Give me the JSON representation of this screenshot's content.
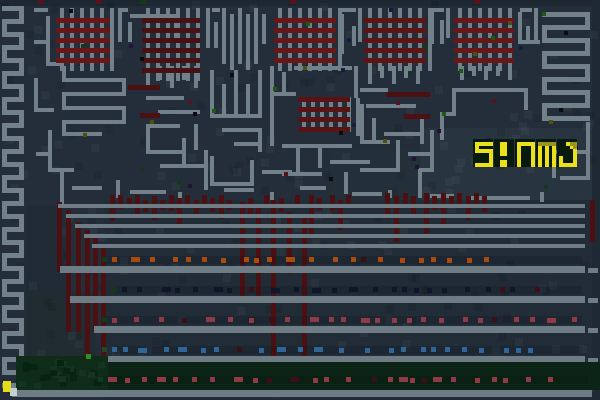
{
  "window": {
    "width": 600,
    "height": 400,
    "kind": "pixel-art game frame"
  },
  "hud": {
    "score_text": "SIUMO",
    "x": 474,
    "y": 140,
    "cell": 3.5,
    "tile_w": 20,
    "tile_h": 28,
    "pitch": 21,
    "tile_bg": "#081a0d",
    "fg": "#ecdf1c",
    "shade": "#99931f",
    "glyphs": {
      "S": [
        "11111",
        "10000",
        "11111",
        "00001",
        "00001",
        "00001",
        "11111"
      ],
      "I": [
        "01100",
        "01100",
        "01100",
        "01100",
        "00000",
        "01100",
        "01100"
      ],
      "U": [
        "11111",
        "10001",
        "10001",
        "10001",
        "10001",
        "10001",
        "10001"
      ],
      "M": [
        "22222",
        "10101",
        "10101",
        "10101",
        "10101",
        "10101",
        "10101"
      ],
      "O": [
        "00122",
        "00012",
        "00001",
        "00001",
        "10001",
        "10001",
        "11111"
      ]
    }
  },
  "palette": {
    "bg": "#232e3a",
    "maze": "#72808a",
    "brick_red": "#661616",
    "brick_red_dark": "#471113",
    "drip": "#4a1012",
    "stripe": "#6e7c85",
    "orange": "#a84b10",
    "crimson": "#8e3b46",
    "blue": "#30659a",
    "navy_dash": "#10152a",
    "green_band": "#0c2415",
    "green_blob": "#0f2c19",
    "yellow_block": "#e3de16",
    "white_block": "#c8d1ce"
  },
  "scene": {
    "patches": [
      [
        0,
        0,
        600,
        6,
        "#1c2731"
      ],
      [
        592,
        0,
        8,
        400,
        "#1e2933"
      ],
      [
        26,
        205,
        44,
        150,
        "#202b36"
      ],
      [
        26,
        292,
        70,
        66,
        "#202c31"
      ],
      [
        420,
        128,
        172,
        72,
        "#283440"
      ],
      [
        330,
        150,
        90,
        46,
        "#243039"
      ],
      [
        104,
        200,
        488,
        200,
        "#212c37"
      ]
    ],
    "left_serpentine": {
      "x0": 2,
      "x1": 24,
      "y0": 6,
      "step": 13,
      "count": 30,
      "t": 5
    },
    "right_radiator": {
      "x0": 542,
      "x1": 590,
      "y0": 12,
      "step": 13,
      "count": 9,
      "t": 5
    },
    "top_vcomb": {
      "x0": 222,
      "y0": 8,
      "h": 56,
      "step": 8,
      "count": 5,
      "t": 4
    },
    "bricks": [
      {
        "x": 56,
        "y": 18,
        "w": 54,
        "bars": 5,
        "bar_h": 5,
        "bar_step": 10,
        "cols": 6,
        "col_w": 4,
        "col_step": 10,
        "red": "#6b1616",
        "ticks": true
      },
      {
        "x": 142,
        "y": 18,
        "w": 58,
        "bars": 6,
        "bar_h": 5,
        "bar_step": 10,
        "cols": 6,
        "col_w": 4,
        "col_step": 10,
        "red": "#471113",
        "ticks": true
      },
      {
        "x": 274,
        "y": 18,
        "w": 62,
        "bars": 5,
        "bar_h": 5,
        "bar_step": 10,
        "cols": 7,
        "col_w": 4,
        "col_step": 10,
        "red": "#6b1616",
        "ticks": true
      },
      {
        "x": 364,
        "y": 18,
        "w": 62,
        "bars": 5,
        "bar_h": 5,
        "bar_step": 10,
        "cols": 7,
        "col_w": 4,
        "col_step": 10,
        "red": "#5f1414",
        "ticks": true
      },
      {
        "x": 454,
        "y": 18,
        "w": 60,
        "bars": 5,
        "bar_h": 5,
        "bar_step": 10,
        "cols": 6,
        "col_w": 4,
        "col_step": 10,
        "red": "#6b1616",
        "ticks": true
      },
      {
        "x": 298,
        "y": 97,
        "w": 52,
        "bars": 4,
        "bar_h": 5,
        "bar_step": 10,
        "cols": 6,
        "col_w": 4,
        "col_step": 9,
        "red": "#5a1313",
        "ticks": false
      }
    ],
    "red_bars": [
      [
        128,
        85,
        32
      ],
      [
        140,
        113,
        20
      ],
      [
        386,
        92,
        44
      ],
      [
        404,
        114,
        26
      ]
    ],
    "maze_segments": [
      [
        34,
        8,
        14,
        4
      ],
      [
        118,
        8,
        10,
        4
      ],
      [
        130,
        14,
        44,
        4
      ],
      [
        212,
        8,
        8,
        4
      ],
      [
        342,
        8,
        14,
        4
      ],
      [
        432,
        8,
        12,
        4
      ],
      [
        520,
        8,
        12,
        4
      ],
      [
        118,
        8,
        4,
        34
      ],
      [
        128,
        22,
        4,
        20
      ],
      [
        174,
        14,
        4,
        28
      ],
      [
        206,
        8,
        4,
        40
      ],
      [
        214,
        22,
        4,
        26
      ],
      [
        262,
        14,
        4,
        30
      ],
      [
        340,
        14,
        4,
        40
      ],
      [
        352,
        26,
        4,
        20
      ],
      [
        358,
        8,
        4,
        34
      ],
      [
        430,
        8,
        4,
        36
      ],
      [
        440,
        20,
        4,
        24
      ],
      [
        446,
        8,
        4,
        30
      ],
      [
        518,
        12,
        4,
        30
      ],
      [
        526,
        26,
        4,
        18
      ],
      [
        534,
        8,
        4,
        36
      ],
      [
        518,
        40,
        22,
        4
      ],
      [
        46,
        16,
        4,
        50
      ],
      [
        34,
        40,
        12,
        4
      ],
      [
        46,
        62,
        16,
        4
      ],
      [
        34,
        78,
        4,
        30
      ],
      [
        34,
        108,
        20,
        4
      ],
      [
        48,
        130,
        4,
        42
      ],
      [
        36,
        152,
        12,
        4
      ],
      [
        48,
        168,
        26,
        4
      ],
      [
        62,
        66,
        4,
        12
      ],
      [
        62,
        78,
        64,
        4
      ],
      [
        122,
        82,
        4,
        10
      ],
      [
        62,
        92,
        64,
        4
      ],
      [
        62,
        96,
        4,
        10
      ],
      [
        62,
        106,
        64,
        4
      ],
      [
        122,
        110,
        4,
        10
      ],
      [
        62,
        120,
        64,
        4
      ],
      [
        62,
        124,
        4,
        8
      ],
      [
        62,
        132,
        40,
        4
      ],
      [
        146,
        66,
        4,
        22
      ],
      [
        158,
        66,
        4,
        14
      ],
      [
        170,
        66,
        4,
        22
      ],
      [
        182,
        66,
        4,
        14
      ],
      [
        194,
        66,
        4,
        22
      ],
      [
        146,
        96,
        38,
        4
      ],
      [
        158,
        110,
        42,
        4
      ],
      [
        146,
        124,
        34,
        4
      ],
      [
        146,
        124,
        4,
        28
      ],
      [
        146,
        150,
        40,
        4
      ],
      [
        182,
        138,
        4,
        30
      ],
      [
        194,
        124,
        4,
        26
      ],
      [
        160,
        164,
        46,
        4
      ],
      [
        204,
        150,
        4,
        40
      ],
      [
        210,
        70,
        4,
        44
      ],
      [
        222,
        84,
        4,
        32
      ],
      [
        234,
        70,
        4,
        44
      ],
      [
        246,
        84,
        4,
        32
      ],
      [
        258,
        70,
        4,
        44
      ],
      [
        210,
        114,
        52,
        4
      ],
      [
        222,
        128,
        40,
        4
      ],
      [
        258,
        128,
        4,
        24
      ],
      [
        234,
        142,
        28,
        4
      ],
      [
        210,
        156,
        4,
        28
      ],
      [
        210,
        182,
        44,
        4
      ],
      [
        250,
        160,
        4,
        24
      ],
      [
        262,
        170,
        30,
        4
      ],
      [
        270,
        66,
        4,
        28
      ],
      [
        282,
        72,
        4,
        22
      ],
      [
        294,
        66,
        58,
        4
      ],
      [
        354,
        66,
        4,
        32
      ],
      [
        270,
        92,
        26,
        4
      ],
      [
        270,
        96,
        4,
        50
      ],
      [
        356,
        98,
        4,
        38
      ],
      [
        282,
        144,
        70,
        4
      ],
      [
        296,
        148,
        4,
        26
      ],
      [
        282,
        172,
        40,
        4
      ],
      [
        318,
        148,
        4,
        20
      ],
      [
        330,
        160,
        40,
        4
      ],
      [
        344,
        172,
        4,
        22
      ],
      [
        368,
        66,
        4,
        18
      ],
      [
        380,
        66,
        4,
        12
      ],
      [
        392,
        66,
        4,
        18
      ],
      [
        404,
        66,
        4,
        12
      ],
      [
        416,
        66,
        4,
        18
      ],
      [
        360,
        88,
        28,
        4
      ],
      [
        366,
        104,
        50,
        4
      ],
      [
        360,
        104,
        4,
        36
      ],
      [
        372,
        118,
        4,
        26
      ],
      [
        384,
        132,
        36,
        4
      ],
      [
        360,
        140,
        30,
        4
      ],
      [
        396,
        140,
        4,
        30
      ],
      [
        360,
        168,
        40,
        4
      ],
      [
        408,
        152,
        26,
        4
      ],
      [
        420,
        118,
        4,
        26
      ],
      [
        430,
        130,
        4,
        42
      ],
      [
        418,
        168,
        16,
        4
      ],
      [
        418,
        170,
        4,
        28
      ],
      [
        430,
        194,
        24,
        4
      ],
      [
        460,
        66,
        4,
        14
      ],
      [
        472,
        66,
        4,
        10
      ],
      [
        484,
        66,
        4,
        14
      ],
      [
        496,
        66,
        4,
        10
      ],
      [
        508,
        66,
        4,
        14
      ],
      [
        456,
        88,
        70,
        4
      ],
      [
        452,
        88,
        4,
        26
      ],
      [
        440,
        112,
        16,
        4
      ],
      [
        440,
        112,
        4,
        28
      ],
      [
        524,
        88,
        4,
        22
      ],
      [
        556,
        150,
        34,
        4
      ],
      [
        552,
        152,
        4,
        26
      ],
      [
        560,
        176,
        30,
        4
      ],
      [
        586,
        122,
        4,
        56
      ],
      [
        60,
        172,
        4,
        32
      ],
      [
        72,
        186,
        30,
        4
      ],
      [
        116,
        180,
        4,
        18
      ],
      [
        130,
        190,
        36,
        4
      ],
      [
        178,
        192,
        4,
        10
      ],
      [
        224,
        188,
        30,
        4
      ],
      [
        270,
        192,
        4,
        8
      ],
      [
        300,
        186,
        26,
        4
      ],
      [
        352,
        192,
        30,
        4
      ],
      [
        388,
        190,
        4,
        8
      ],
      [
        470,
        196,
        60,
        4
      ],
      [
        540,
        192,
        4,
        10
      ]
    ],
    "drips": [
      [
        57,
        202,
        70
      ],
      [
        66,
        210,
        122
      ],
      [
        76,
        222,
        110
      ],
      [
        85,
        230,
        160
      ],
      [
        93,
        238,
        94
      ],
      [
        101,
        246,
        148
      ],
      [
        110,
        195,
        26
      ],
      [
        118,
        195,
        14
      ],
      [
        127,
        198,
        10
      ],
      [
        135,
        195,
        20
      ],
      [
        143,
        200,
        12
      ],
      [
        152,
        196,
        24
      ],
      [
        160,
        200,
        10
      ],
      [
        169,
        195,
        16
      ],
      [
        177,
        198,
        26
      ],
      [
        185,
        195,
        12
      ],
      [
        194,
        200,
        18
      ],
      [
        202,
        195,
        10
      ],
      [
        210,
        198,
        14
      ],
      [
        219,
        195,
        24
      ],
      [
        227,
        200,
        10
      ],
      [
        240,
        202,
        100
      ],
      [
        248,
        198,
        16
      ],
      [
        256,
        208,
        92
      ],
      [
        264,
        195,
        12
      ],
      [
        271,
        200,
        194
      ],
      [
        279,
        198,
        14
      ],
      [
        287,
        212,
        62
      ],
      [
        295,
        195,
        10
      ],
      [
        302,
        218,
        140
      ],
      [
        309,
        195,
        42
      ],
      [
        317,
        198,
        12
      ],
      [
        330,
        195,
        16
      ],
      [
        338,
        200,
        30
      ],
      [
        346,
        195,
        10
      ],
      [
        385,
        193,
        26
      ],
      [
        394,
        196,
        46
      ],
      [
        403,
        193,
        12
      ],
      [
        411,
        196,
        20
      ],
      [
        424,
        193,
        40
      ],
      [
        432,
        196,
        14
      ],
      [
        441,
        193,
        34
      ],
      [
        449,
        196,
        10
      ],
      [
        457,
        193,
        14
      ],
      [
        466,
        196,
        24
      ],
      [
        474,
        193,
        12
      ],
      [
        482,
        196,
        16
      ],
      [
        590,
        200,
        42
      ]
    ],
    "stripes": {
      "x1": 585,
      "thin": [
        [
          204,
          58
        ],
        [
          214,
          66
        ],
        [
          224,
          75
        ],
        [
          234,
          84
        ],
        [
          244,
          92
        ]
      ],
      "thick": [
        [
          266,
          60
        ],
        [
          296,
          70
        ],
        [
          326,
          94
        ],
        [
          356,
          104
        ]
      ],
      "bottom": [
        390,
        12,
        592
      ],
      "h_thin": 4,
      "h_thick": 7,
      "end_blocks": [
        [
          588,
          268
        ],
        [
          588,
          298
        ],
        [
          588,
          328
        ],
        [
          588,
          358
        ]
      ]
    },
    "dash_rows": [
      {
        "y": 257,
        "color": "#a84b10",
        "x0": 108,
        "x1": 582,
        "n": 22,
        "lead": "#15381b",
        "seed": 11
      },
      {
        "y": 287,
        "color": "#10152a",
        "x0": 118,
        "x1": 582,
        "n": 24,
        "lead": "#15381b",
        "seed": 23
      },
      {
        "y": 317,
        "color": "#8e3b46",
        "x0": 108,
        "x1": 582,
        "n": 26,
        "lead": "#15381b",
        "seed": 37
      },
      {
        "y": 347,
        "color": "#30659a",
        "x0": 108,
        "x1": 582,
        "n": 24,
        "lead": "#1c4a2a",
        "seed": 51
      },
      {
        "y": 377,
        "color": "#8e3b46",
        "x0": 104,
        "x1": 588,
        "n": 26,
        "lead": "#0f3a1f",
        "seed": 67
      }
    ],
    "ground": {
      "band": [
        104,
        362,
        496,
        28,
        "#0c2415"
      ],
      "blob": [
        16,
        356,
        92,
        34,
        "#0f2c19"
      ],
      "yellow": [
        3,
        381,
        8,
        11
      ],
      "white": [
        10,
        388,
        7,
        8
      ],
      "bright_green_dot": [
        86,
        354,
        5,
        5,
        "#2f8f1f"
      ]
    },
    "dots": {
      "n": 46,
      "seed": 9,
      "x0": 30,
      "x1": 588,
      "y0": 8,
      "y1": 196,
      "colors": [
        "#15381b",
        "#58121a",
        "#241238",
        "#12203f",
        "#4f4f10",
        "#1c5a10",
        "#0c0c10"
      ]
    },
    "top_dots": [
      [
        38,
        0,
        "#58121a"
      ],
      [
        96,
        0,
        "#58121a"
      ],
      [
        290,
        0,
        "#58121a"
      ],
      [
        474,
        0,
        "#58121a"
      ],
      [
        140,
        0,
        "#15381b"
      ]
    ],
    "mottle": {
      "n": 230,
      "seed": 3,
      "size": 8
    }
  }
}
